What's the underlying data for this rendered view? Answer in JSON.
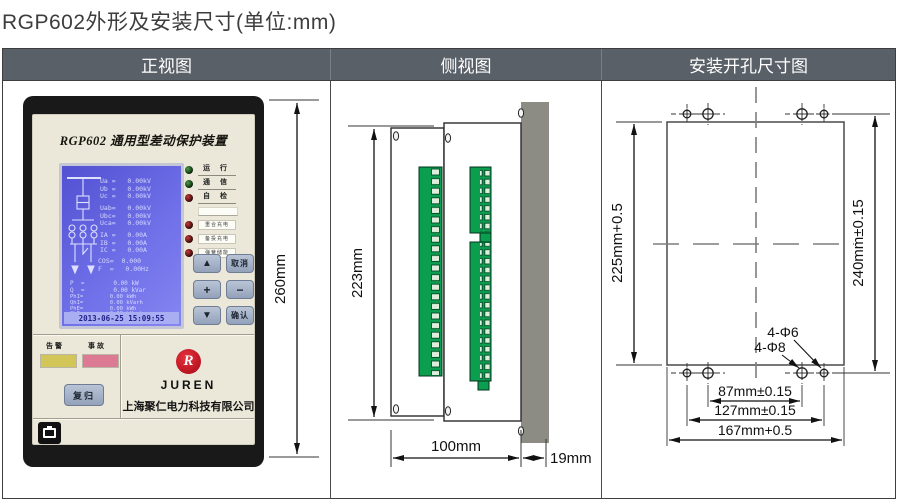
{
  "page": {
    "title": "RGP602外形及安装尺寸(单位:mm)"
  },
  "table": {
    "headers": [
      "正视图",
      "侧视图",
      "安装开孔尺寸图"
    ]
  },
  "device": {
    "title": "RGP602 通用型差动保护装置",
    "lcd": {
      "phase": [
        "Ua =   0.00kV",
        "Ub =   0.00kV",
        "Uc =   0.00kV"
      ],
      "line": [
        "Uab=   0.00kV",
        "Ubc=   0.00kV",
        "Uca=   0.00kV"
      ],
      "curr": [
        "IA =   0.00A",
        "IB =   0.00A",
        "IC =   0.00A"
      ],
      "cosf": [
        "COS=  0.000",
        "F  =   0.00Hz"
      ],
      "power": [
        "P  =        0.00 kW",
        "Q  =        0.00 kVar"
      ],
      "energy": [
        "PhI=        0.00 kWh",
        "QhI=        0.00 kVarh",
        "PhE=        0.00 kWh",
        "QhE=        0.00 kVarh"
      ],
      "datetime": "2013-06-25 15:09:55"
    },
    "status_leds": [
      {
        "label": "运 行",
        "color": "green"
      },
      {
        "label": "通 信",
        "color": "green"
      },
      {
        "label": "自 检",
        "color": "red"
      }
    ],
    "alarm_leds": [
      "重合充电",
      "备投充电",
      "弹簧储能"
    ],
    "keypad": {
      "up": "▲",
      "cancel": "取消",
      "plus": "+",
      "minus": "−",
      "down": "▼",
      "confirm": "确认"
    },
    "alarm_labels": {
      "warn": "告警",
      "fault": "事故"
    },
    "reset_button": "复归",
    "brand": {
      "logo_letter": "R",
      "name": "JUREN",
      "company": "上海聚仁电力科技有限公司"
    },
    "dim_height": "260mm"
  },
  "side_view": {
    "dim_height": "223mm",
    "dim_depth": "100mm",
    "dim_flange": "19mm"
  },
  "cutout_view": {
    "dim_left": "225mm+0.5",
    "dim_right": "240mm±0.15",
    "hole_label_small": "4-Φ6",
    "hole_label_large": "4-Φ8",
    "dim_inner": "87mm±0.15",
    "dim_outer": "127mm±0.15",
    "dim_width": "167mm+0.5"
  },
  "colors": {
    "header_bg": "#5a6068",
    "lcd_blue": "#6a6ae0",
    "terminal_green": "#0a9e4e",
    "flange_gray": "#8c8c84",
    "warn_yellow": "#d2c659",
    "fault_pink": "#dc7a93",
    "brand_red": "#cf1b26",
    "button_gray_blue": "#a3b0c6"
  }
}
